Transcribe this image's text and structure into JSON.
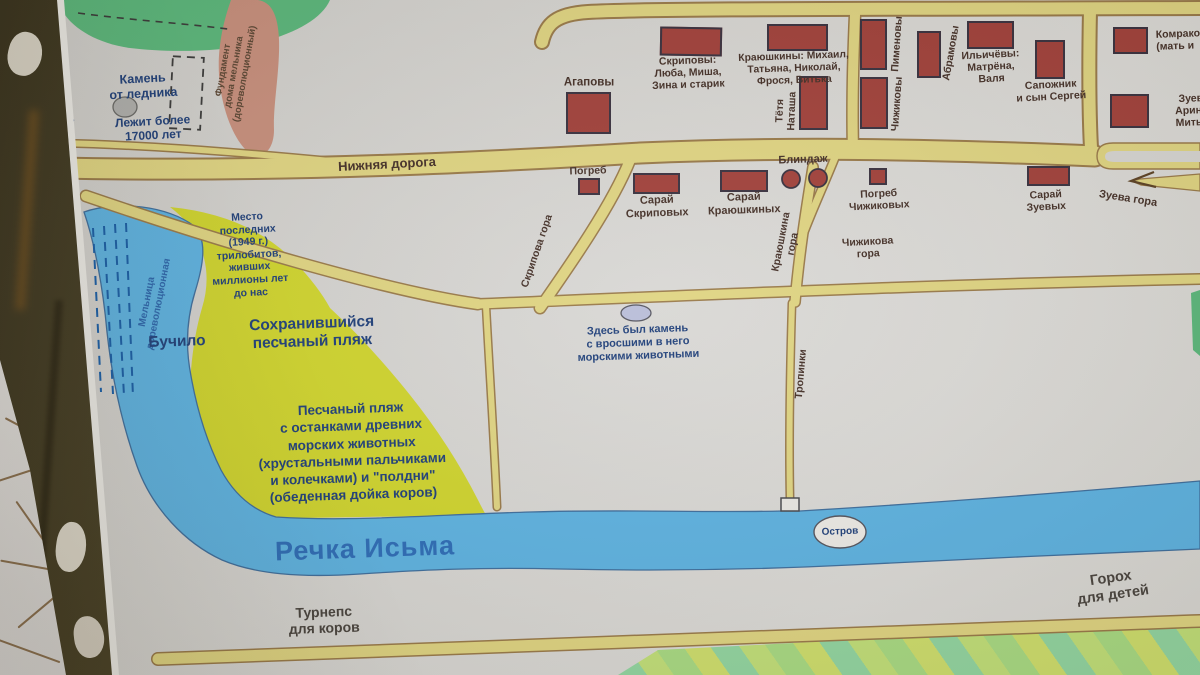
{
  "nature": {
    "ozhnevka": "Ожневка",
    "glacier_stone": [
      "Камень",
      "от ледника"
    ],
    "glacier_age": [
      "Лежит более",
      "17000 лет"
    ],
    "mill_foundation": [
      "Фундамент",
      "дома мельника",
      "(дореволюционный)"
    ],
    "mill_old": [
      "Мельница",
      "дореволюционная"
    ],
    "buchilo": "Бучило",
    "trilobites": [
      "Место",
      "последних",
      "(1949 г.)",
      "трилобитов,",
      "живших",
      "миллионы лет",
      "до нас"
    ],
    "preserved_beach": [
      "Сохранившийся",
      "песчаный пляж"
    ],
    "stone_here": [
      "Здесь был камень",
      "с вросшими в него",
      "морскими животными"
    ],
    "sandy_beach": [
      "Песчаный пляж",
      "с останками древних",
      "морских животных",
      "(хрустальными пальчиками",
      "и колечками) и \"полдни\"",
      "(обеденная дойка коров)"
    ],
    "river": "Речка Исьма",
    "island": "Остров",
    "turnips": [
      "Турнепс",
      "для коров"
    ],
    "peas": [
      "Горох",
      "для детей"
    ]
  },
  "roads": {
    "nizhnyaya": "Нижняя дорога",
    "skripova_gora": "Скрипова гора",
    "krayushkina_gora": [
      "Краюшкина",
      "гора"
    ],
    "chizhikova_gora": [
      "Чижикова",
      "гора"
    ],
    "zueva_gora": "Зуева гора",
    "tropinki": "Тропинки"
  },
  "houses": {
    "agapovy": {
      "label": [
        "Агаповы"
      ]
    },
    "skripovy": {
      "label": [
        "Скриповы:",
        "Люба, Миша,",
        "Зина и старик"
      ]
    },
    "krayushkiny": {
      "label": [
        "Краюшкины: Михаил,",
        "Татьяна, Николай,",
        "Фрося, Витька"
      ]
    },
    "tetya_natasha": {
      "label": [
        "Тётя",
        "Наташа"
      ]
    },
    "pimenovy": {
      "label": [
        "Пименовы"
      ]
    },
    "chizhikovy": {
      "label": [
        "Чижиковы"
      ]
    },
    "abramovy": {
      "label": [
        "Абрамовы"
      ]
    },
    "ilichyovy": {
      "label": [
        "Ильичёвы:",
        "Матрёна,",
        "Валя"
      ]
    },
    "sapozhnik": {
      "label": [
        "Сапожник",
        "и сын Сергей"
      ]
    },
    "komrakovy": {
      "label": [
        "Комраковы",
        "(мать и"
      ]
    },
    "zuevy": {
      "label": [
        "Зуевы:",
        "Аринка,",
        "Митька,"
      ]
    }
  },
  "structures": {
    "pogreb_skripovykh": {
      "label": [
        "Погреб"
      ]
    },
    "saray_skripovykh": {
      "label": [
        "Сарай",
        "Скриповых"
      ]
    },
    "saray_krayushkinykh": {
      "label": [
        "Сарай",
        "Краюшкиных"
      ]
    },
    "blindazh": {
      "label": [
        "Блиндаж"
      ]
    },
    "pogreb_chizhikovykh": {
      "label": [
        "Погреб",
        "Чижиковых"
      ]
    },
    "saray_zuevykh": {
      "label": [
        "Сарай",
        "Зуевых"
      ]
    }
  },
  "colors": {
    "road_fill": "#e0d583",
    "road_border": "#9a7b4b",
    "house_fill": "#a2423c",
    "water": "#5eb3e2",
    "beach": "#d0d52f",
    "forest_green": "#5cb87d",
    "foundation_blob": "#c8907e",
    "label_navy": "#21417b",
    "label_dark": "#46322a",
    "river_label_blue": "#2e6db8"
  }
}
